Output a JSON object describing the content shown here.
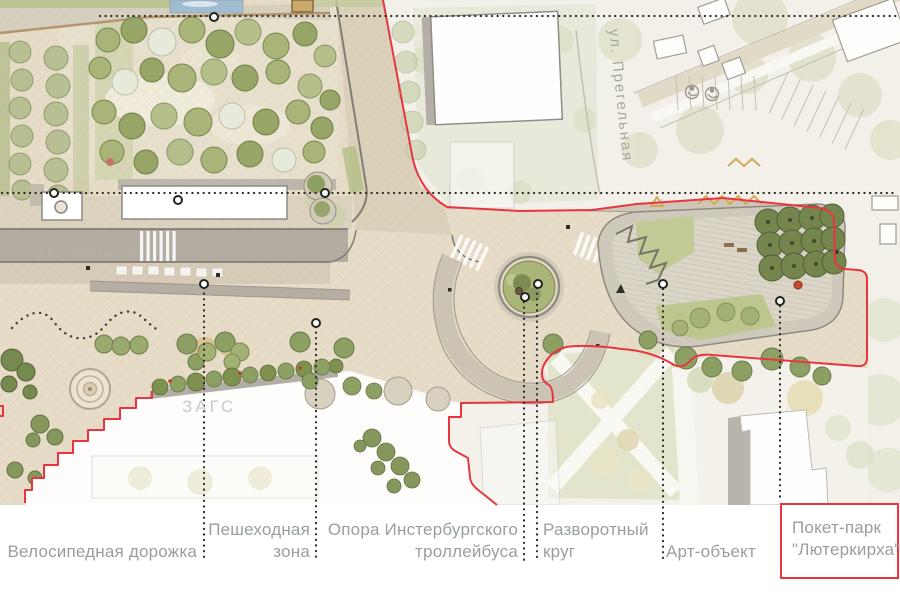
{
  "map": {
    "street_label_lenina": "ул. Ленина",
    "street_label_pregelnaya": "ул. Прегельная",
    "building_label_zags": "ЗАГС"
  },
  "legend": {
    "bike_path": {
      "label": "Велосипедная дорожка"
    },
    "pedestrian_zone": {
      "line1": "Пешеходная",
      "line2": "зона"
    },
    "trolleybus_pole": {
      "line1": "Опора Инстербургского",
      "line2": "троллейбуса"
    },
    "turning_circle": {
      "line1": "Разворотный",
      "line2": "круг"
    },
    "art_object": {
      "label": "Арт-объект"
    },
    "pocket_park": {
      "line1": "Покет-парк",
      "line2": "\"Лютеркирха\""
    }
  },
  "colors": {
    "boundary_red": "#e8353f",
    "label_gray": "#989ea2",
    "plaza_beige": "#e6dcc7",
    "road_gray": "#b3aca1",
    "park_green": "#a3b074",
    "lawn_green": "#c2cb95",
    "marker_black": "#23231f",
    "background": "#ffffff"
  }
}
